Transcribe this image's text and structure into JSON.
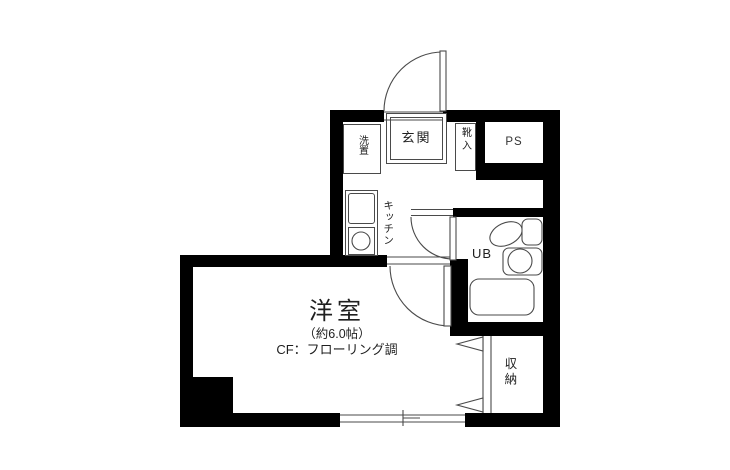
{
  "title": "apartment-floor-plan",
  "colors": {
    "wall": "#000000",
    "line": "#4a4a4a",
    "text": "#1f1f1f",
    "bg": "#ffffff"
  },
  "rooms": {
    "entrance": {
      "label": "玄関"
    },
    "washer": {
      "label": "洗置"
    },
    "shoe": {
      "label": "靴入"
    },
    "pipe_space": {
      "label": "PS"
    },
    "kitchen": {
      "label": "キッチン"
    },
    "bath": {
      "label": "UB"
    },
    "closet": {
      "label": "収納"
    },
    "main_room": {
      "name": "洋室",
      "size": "（約6.0帖）",
      "floor": "CF：フローリング調"
    }
  }
}
